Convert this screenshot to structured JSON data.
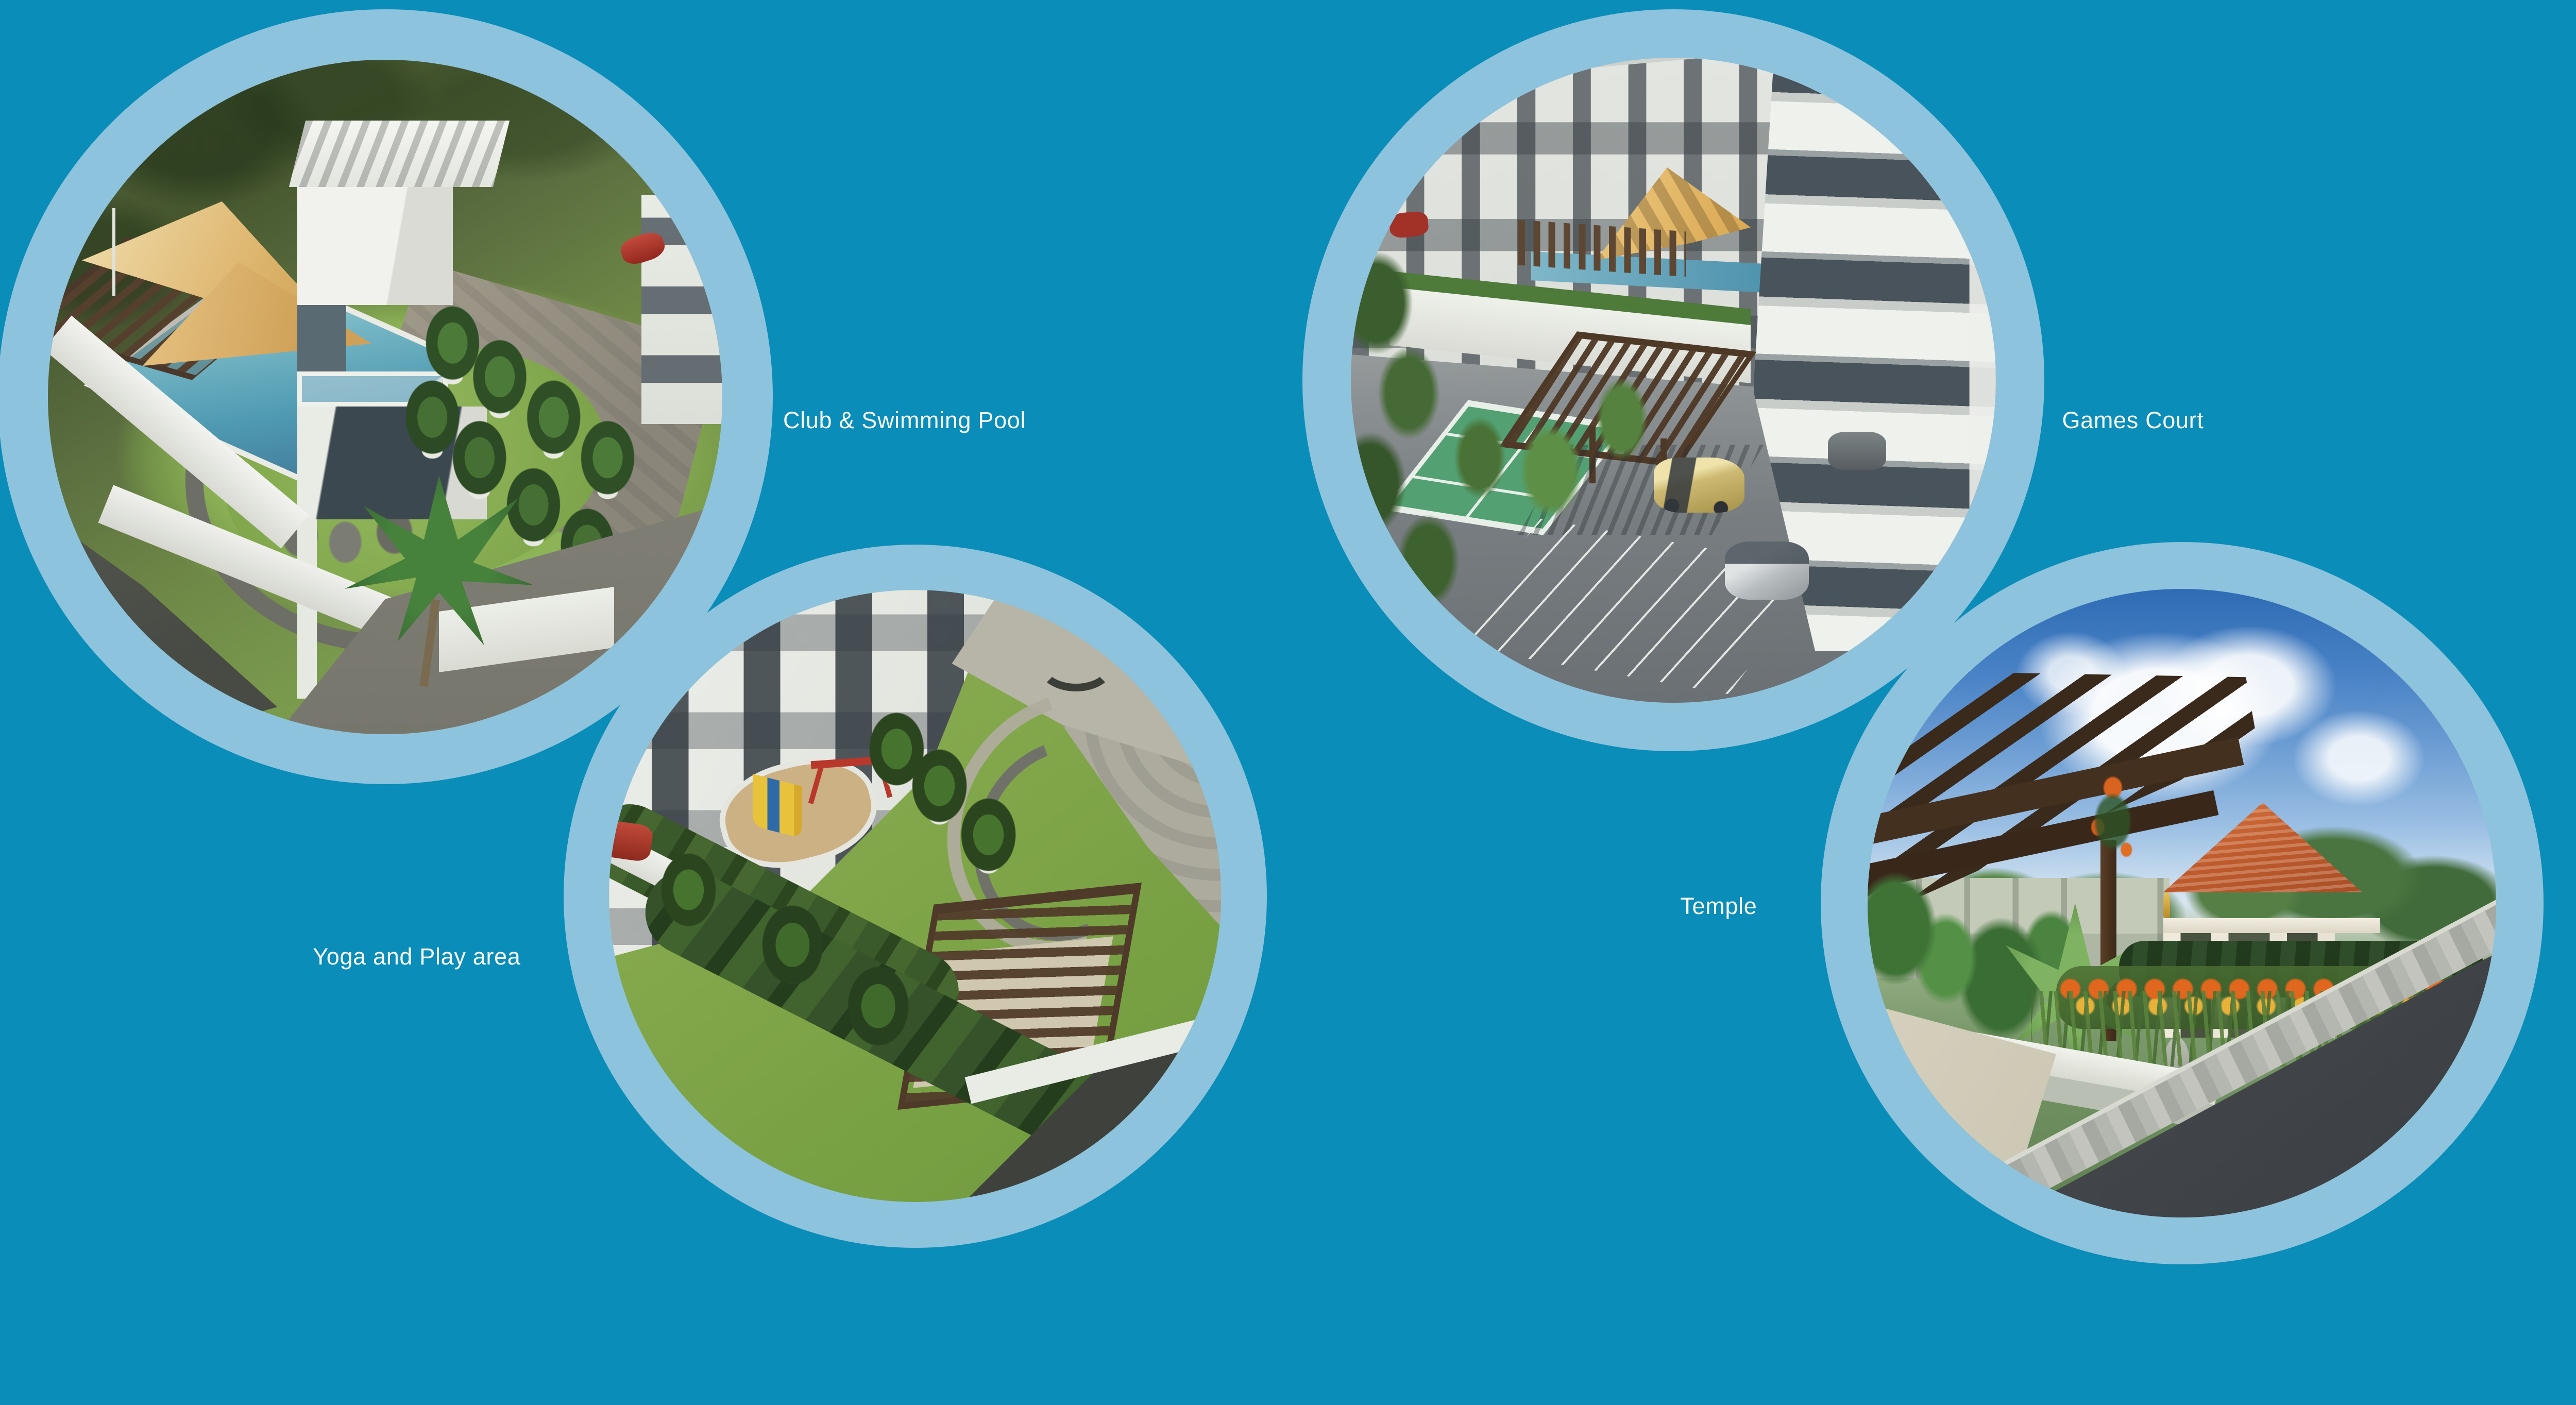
{
  "page": {
    "description": "Real estate brochure amenities page with four circular renders",
    "background_color": "#0a8db8",
    "ring_color": "#8ec3dd",
    "label_color": "#f6fbfd"
  },
  "amenities": [
    {
      "id": "club-swimming-pool",
      "label": "Club & Swimming Pool"
    },
    {
      "id": "yoga-play-area",
      "label": "Yoga and Play area"
    },
    {
      "id": "games-court",
      "label": "Games Court"
    },
    {
      "id": "temple",
      "label": "Temple"
    }
  ]
}
